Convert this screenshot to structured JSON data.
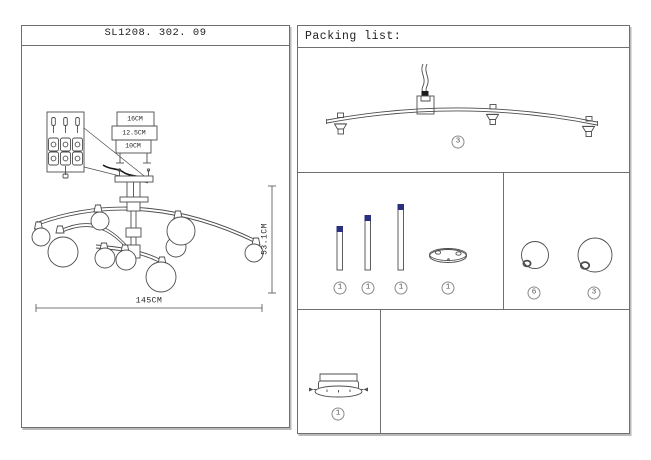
{
  "sheet": {
    "model_number": "SL1208. 302. 09",
    "dimensions": {
      "canopy_width_outer": "16CM",
      "canopy_width_middle": "12.5CM",
      "canopy_width_inner": "10CM",
      "fixture_height": "53.1CM",
      "fixture_width": "145CM"
    }
  },
  "packing_list": {
    "header": "Packing list:",
    "quantities": {
      "curved_arm_assembly": "3",
      "rod_short": "1",
      "rod_medium": "1",
      "rod_long": "1",
      "mounting_ring": "1",
      "globe_small": "6",
      "globe_large": "3",
      "ceiling_canopy": "1"
    }
  },
  "colors": {
    "line": "#4d4d4d",
    "rod_cap_navy": "#2a2f7e",
    "wire_black": "#1c1c1c"
  }
}
